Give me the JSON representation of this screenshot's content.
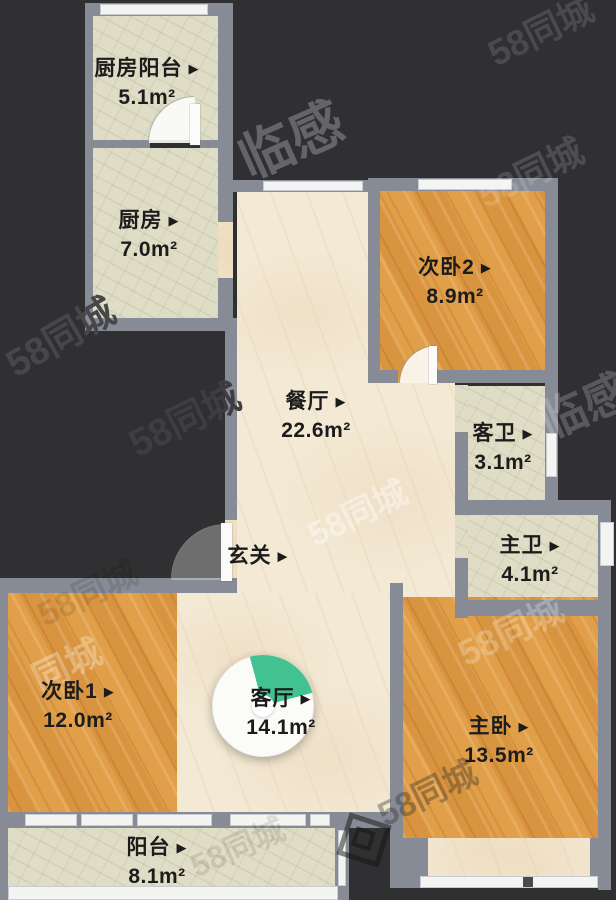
{
  "ui": {
    "arrow": "▶"
  },
  "floorplan": {
    "source_watermark_brand": "58同城",
    "colors": {
      "background": "#303032",
      "wall": "#868b95",
      "window": "#f4f4f3",
      "floor_marble": "#f3e9d4",
      "floor_tile": "#dfddc6",
      "floor_wood": "#de9a44",
      "compass_wedge": "#42c191",
      "label_text": "#1c1c1c"
    },
    "rooms": [
      {
        "label": "厨房阳台",
        "area": "5.1m²"
      },
      {
        "label": "厨房",
        "area": "7.0m²"
      },
      {
        "label": "次卧2",
        "area": "8.9m²"
      },
      {
        "label": "餐厅",
        "area": "22.6m²"
      },
      {
        "label": "客卫",
        "area": "3.1m²"
      },
      {
        "label": "主卫",
        "area": "4.1m²"
      },
      {
        "label": "玄关",
        "area": ""
      },
      {
        "label": "次卧1",
        "area": "12.0m²"
      },
      {
        "label": "客厅",
        "area": "14.1m²"
      },
      {
        "label": "主卧",
        "area": "13.5m²"
      },
      {
        "label": "阳台",
        "area": "8.1m²"
      }
    ],
    "compass": {
      "wedge_color": "#42c191",
      "wedge_start_deg": -15,
      "wedge_end_deg": 75
    },
    "watermarks": [
      {
        "text": "58同城"
      },
      {
        "text": "58同城"
      },
      {
        "text": "58同城"
      },
      {
        "text": "临感"
      },
      {
        "text": "58同城"
      },
      {
        "text": "58同城"
      },
      {
        "text": "临感"
      },
      {
        "text": "58同城"
      },
      {
        "text": "同城"
      },
      {
        "text": "58同城"
      },
      {
        "text": "58同城"
      },
      {
        "text": "58同城"
      },
      {
        "text": "58同城"
      }
    ]
  }
}
